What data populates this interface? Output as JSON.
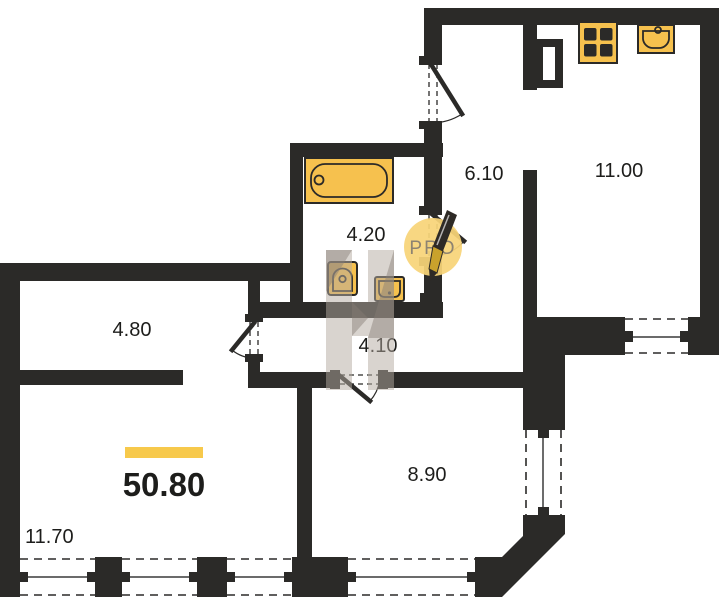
{
  "plan": {
    "total_area": "50.80",
    "watermark": "PRO",
    "rooms": [
      {
        "key": "hallway",
        "area": "4.80"
      },
      {
        "key": "entry-hall",
        "area": "6.10"
      },
      {
        "key": "kitchen",
        "area": "11.00"
      },
      {
        "key": "bathroom",
        "area": "4.20"
      },
      {
        "key": "corridor",
        "area": "4.10"
      },
      {
        "key": "bedroom",
        "area": "8.90"
      },
      {
        "key": "living-room",
        "area": "11.70"
      }
    ],
    "fixtures": [
      "bathtub-icon",
      "toilet-icon",
      "washbasin-icon",
      "stove-icon",
      "kitchen-sink-icon"
    ],
    "colors": {
      "wall": "#2b2a28",
      "fixture_fill": "#f6c14e",
      "accent_bar": "#f7c94b",
      "watermark_circle": "#f8d478",
      "watermark_text": "#8d8371",
      "watermark_gray": "#b3a99f",
      "label": "#1d1d1b"
    }
  }
}
